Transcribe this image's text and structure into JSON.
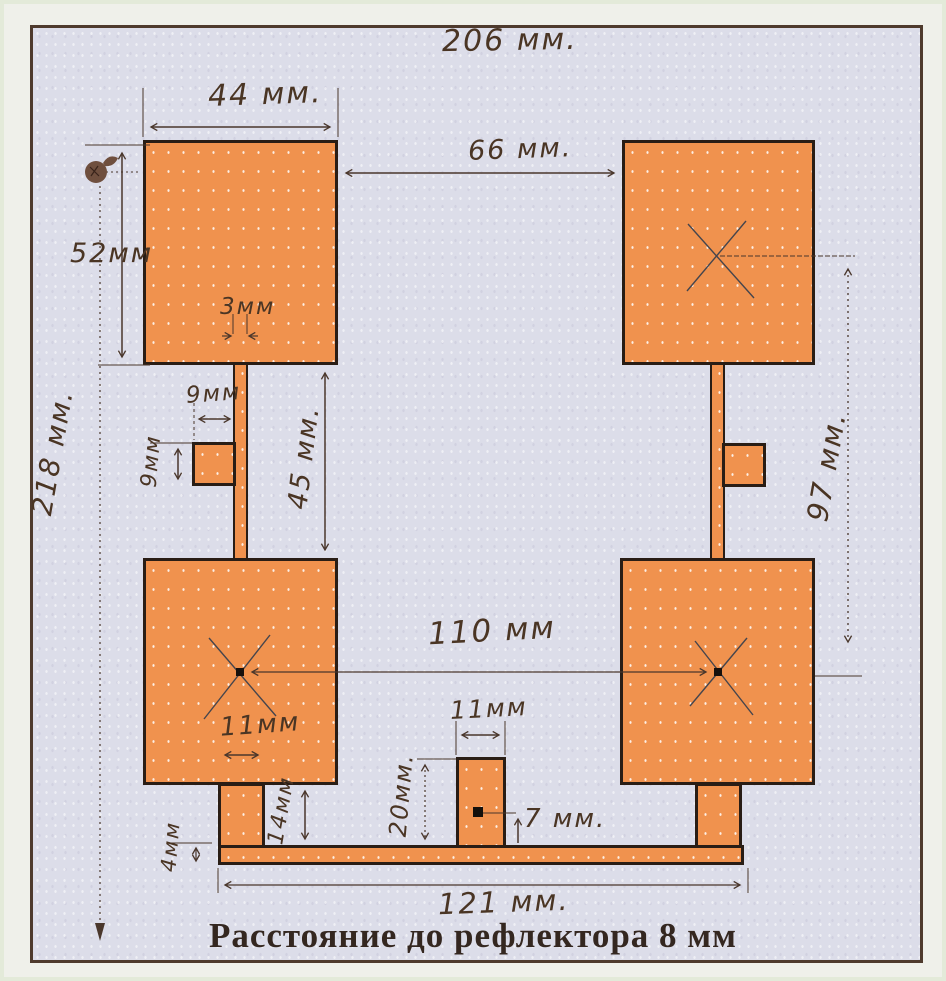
{
  "page": {
    "title": "Расстояние до рефлектора 8 мм"
  },
  "dimensions": {
    "reflector_width": "206 мм.",
    "patch_width": "44 мм.",
    "top_gap": "66 мм.",
    "patch_height": "52мм",
    "reflector_height": "218 мм.",
    "feed_line_width": "3мм",
    "left_tab_width": "9мм",
    "left_tab_height": "9мм",
    "patch_vertical_gap": "45 мм.",
    "centers_vertical_distance": "97 мм.",
    "centers_horizontal_distance": "110 мм",
    "left_leg_width": "11мм",
    "left_leg_height": "14мм",
    "bottom_bar_thickness": "4мм",
    "center_stub_width": "11мм",
    "center_stub_height": "20мм.",
    "feed_point_offset": "7 мм.",
    "bottom_bar_length": "121 мм."
  },
  "colors": {
    "copper": "#f0924e",
    "ink": "#4a372c",
    "paper": "#dcdde9",
    "frame_border": "#4e3a2d"
  }
}
